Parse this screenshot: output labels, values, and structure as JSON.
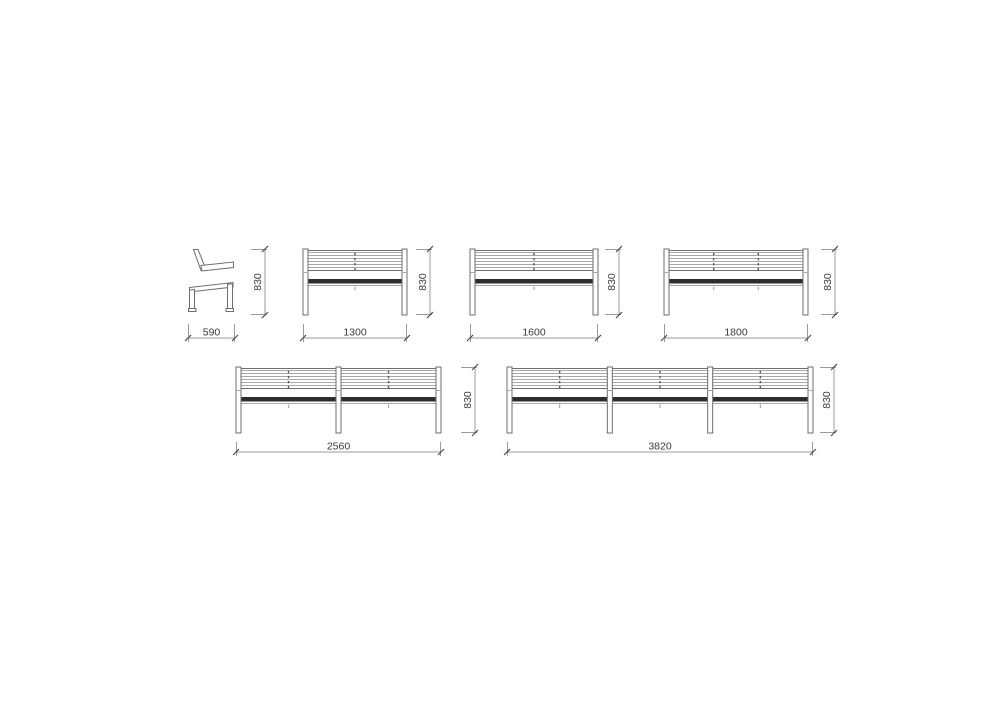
{
  "drawing": {
    "title": "Bench elevations technical drawing",
    "units": "mm",
    "colors": {
      "background": "#ffffff",
      "line": "#6e6e6e",
      "slat": "#a8a8a8",
      "seat": "#2d2d2d",
      "dim": "#9b9b9b",
      "tick": "#4a4a4a",
      "text": "#3a3a3a"
    },
    "views": [
      {
        "id": "bench-side-view",
        "kind": "side",
        "name": "Side elevation",
        "width_mm": "590",
        "height_mm": "830",
        "posts": 2,
        "joints_per_bay": 0
      },
      {
        "id": "bench-front-1300",
        "kind": "front",
        "name": "Front elevation 1300",
        "width_mm": "1300",
        "height_mm": "830",
        "posts": 2,
        "joints_per_bay": 1
      },
      {
        "id": "bench-front-1600",
        "kind": "front",
        "name": "Front elevation 1600",
        "width_mm": "1600",
        "height_mm": "830",
        "posts": 2,
        "joints_per_bay": 1
      },
      {
        "id": "bench-front-1800",
        "kind": "front",
        "name": "Front elevation 1800",
        "width_mm": "1800",
        "height_mm": "830",
        "posts": 2,
        "joints_per_bay": 2
      },
      {
        "id": "bench-front-2560",
        "kind": "front",
        "name": "Front elevation 2560",
        "width_mm": "2560",
        "height_mm": "830",
        "posts": 3,
        "joints_per_bay": 1
      },
      {
        "id": "bench-front-3820",
        "kind": "front",
        "name": "Front elevation 3820",
        "width_mm": "3820",
        "height_mm": "830",
        "posts": 4,
        "joints_per_bay": 1
      }
    ]
  }
}
